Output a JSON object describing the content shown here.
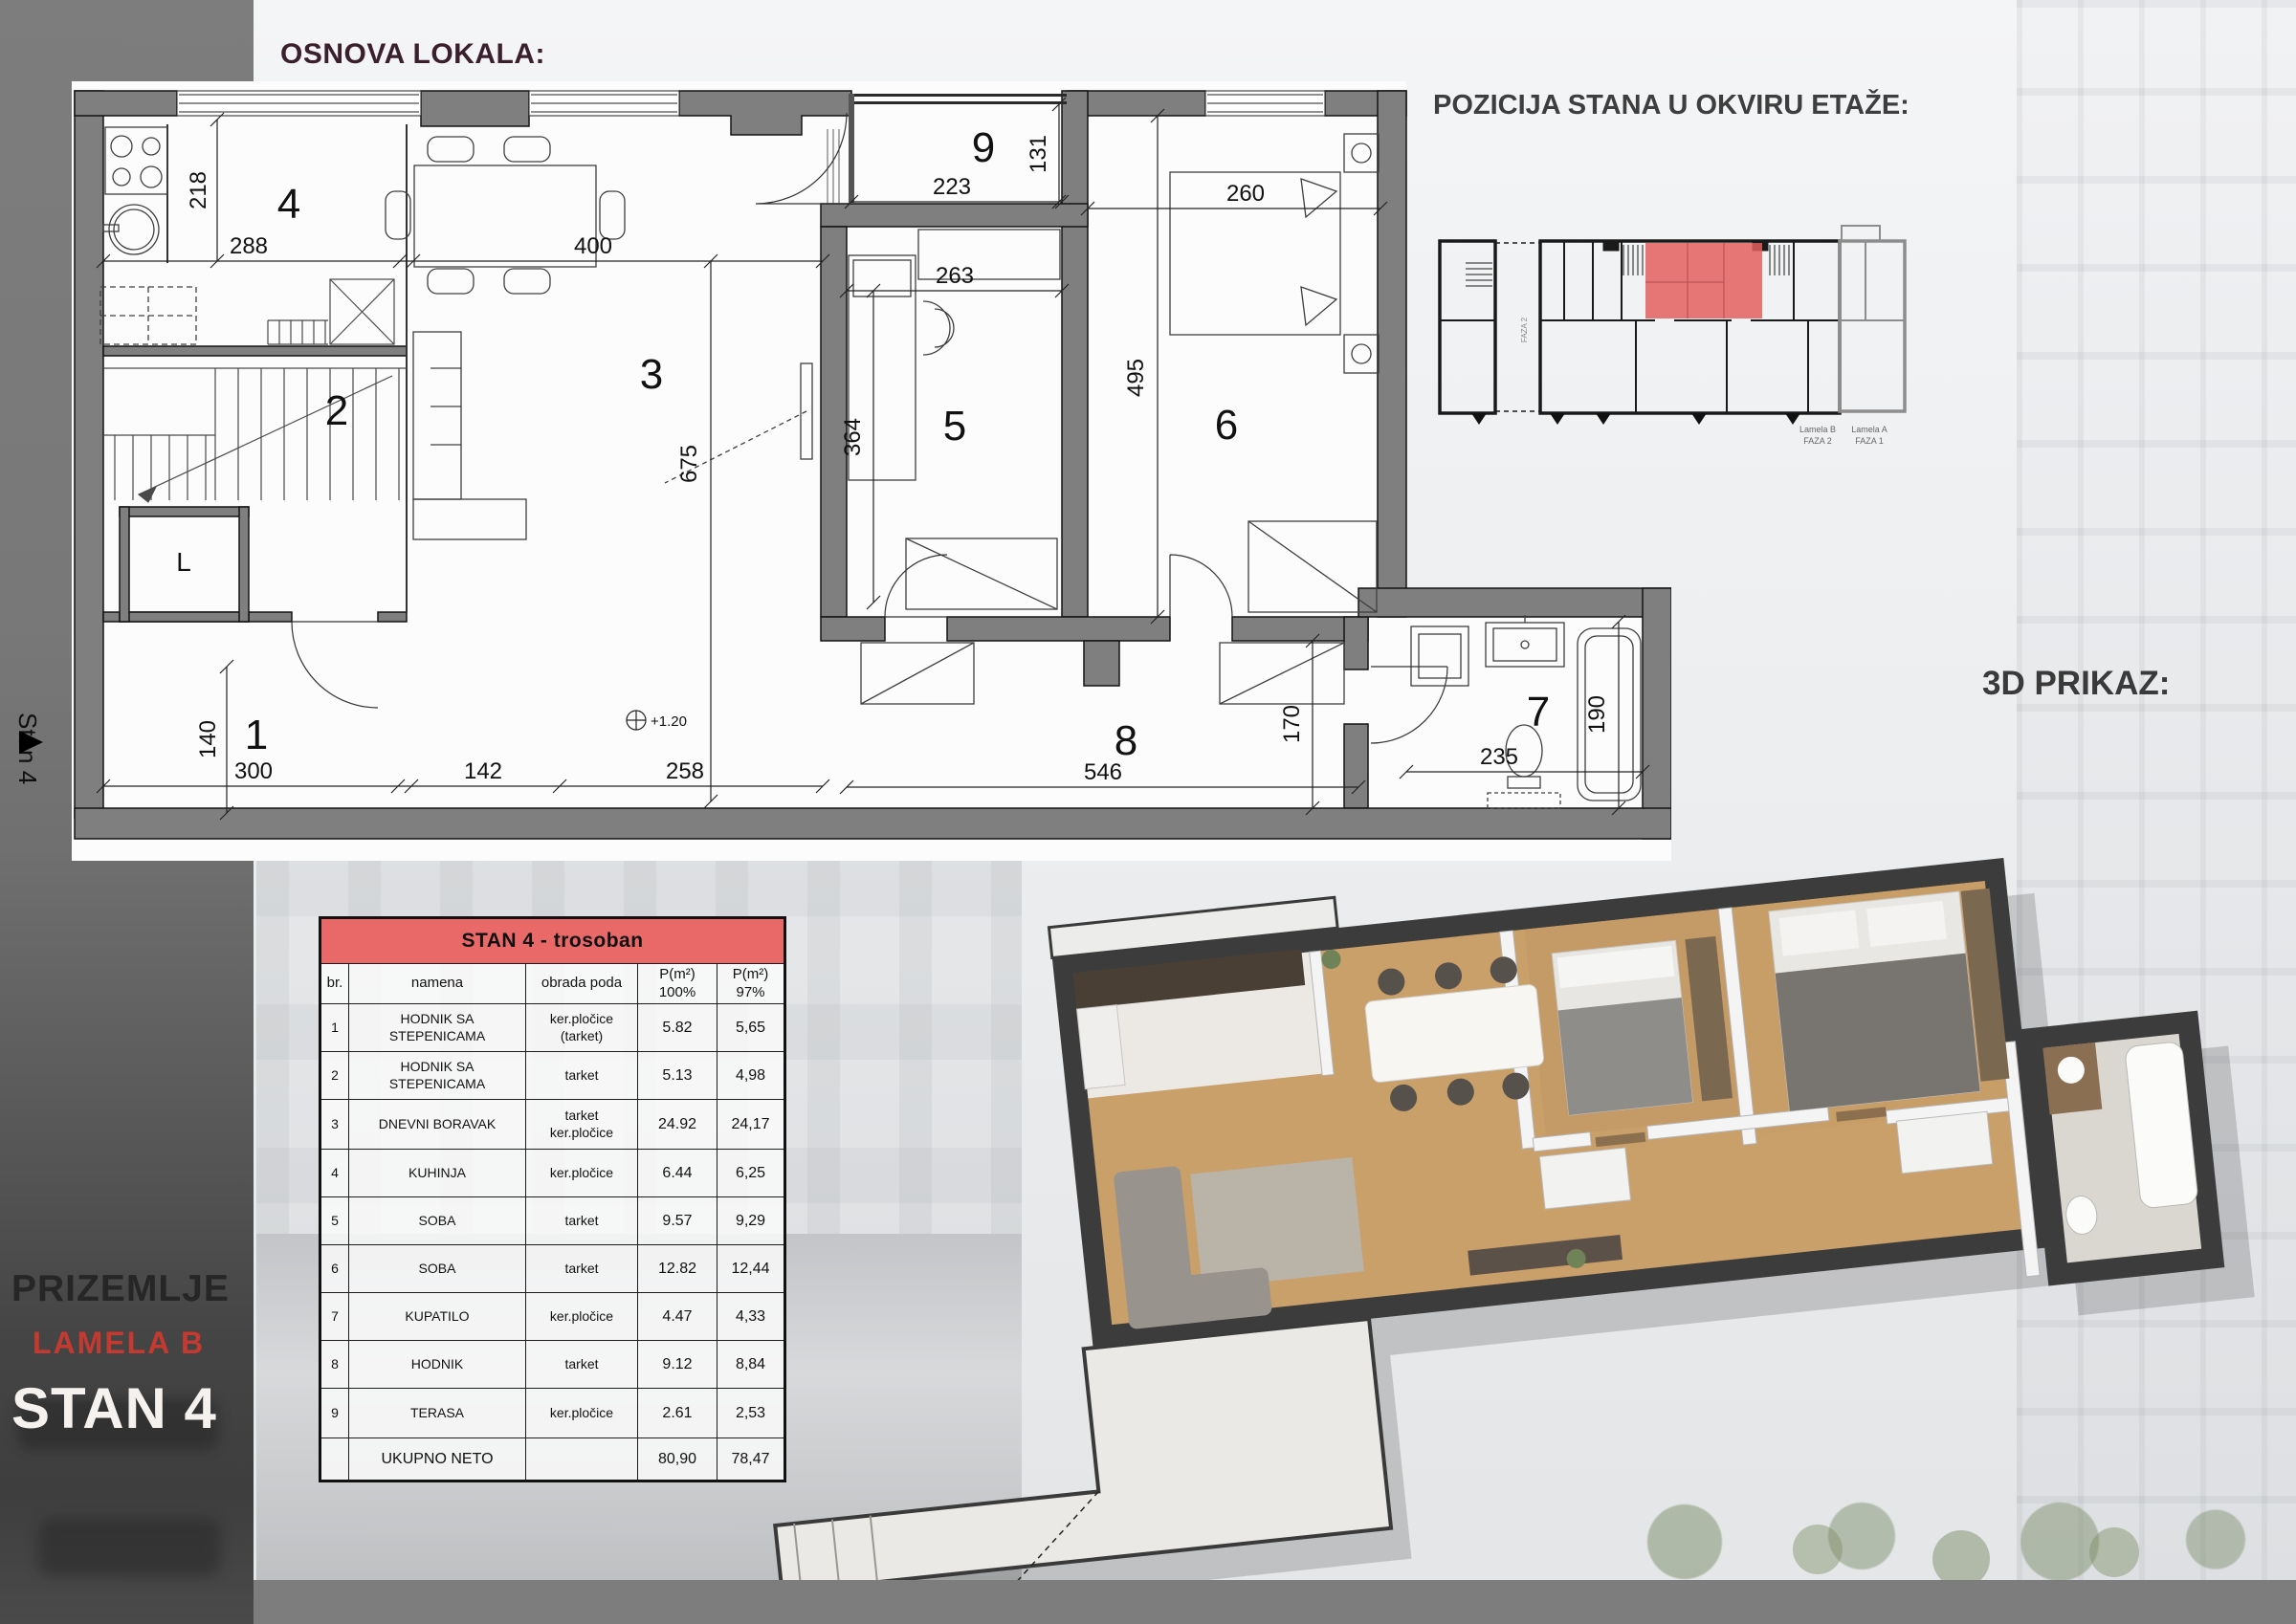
{
  "titles": {
    "osnova": "OSNOVA LOKALA:",
    "pozicija": "POZICIJA STANA U OKVIRU ETAŽE:",
    "prikaz3d": "3D PRIKAZ:"
  },
  "side_tab": {
    "label": "Stan 4"
  },
  "project": {
    "level": "PRIZEMLJE",
    "lamela": "LAMELA  B",
    "unit": "STAN 4"
  },
  "floorplan": {
    "rooms": {
      "r1": "1",
      "r2": "2",
      "r3": "3",
      "r4": "4",
      "r5": "5",
      "r6": "6",
      "r7": "7",
      "r8": "8",
      "r9": "9"
    },
    "elevator": "L",
    "level_mark": "+1.20",
    "dims": {
      "d140": "140",
      "d300": "300",
      "d142": "142",
      "d258": "258",
      "d218": "218",
      "d288": "288",
      "d400": "400",
      "d675": "675",
      "d223": "223",
      "d131": "131",
      "d263": "263",
      "d364": "364",
      "d260": "260",
      "d495": "495",
      "d546": "546",
      "d170": "170",
      "d235": "235",
      "d190": "190"
    }
  },
  "etage": {
    "faza_divider": "FAZA 2",
    "lamela_b_line1": "Lamela B",
    "lamela_b_line2": "FAZA 2",
    "lamela_a_line1": "Lamela A",
    "lamela_a_line2": "FAZA 1"
  },
  "table": {
    "title": "STAN  4 - trosoban",
    "headers": {
      "br": "br.",
      "namena": "namena",
      "obrada": "obrada poda",
      "p100": "P(m²)\n100%",
      "p97": "P(m²)\n97%"
    },
    "rows": [
      {
        "br": "1",
        "namena": "HODNIK SA\nSTEPENICAMA",
        "obrada": "ker.pločice\n(tarket)",
        "p100": "5.82",
        "p97": "5,65"
      },
      {
        "br": "2",
        "namena": "HODNIK SA\nSTEPENICAMA",
        "obrada": "tarket",
        "p100": "5.13",
        "p97": "4,98"
      },
      {
        "br": "3",
        "namena": "DNEVNI BORAVAK",
        "obrada": "tarket\nker.pločice",
        "p100": "24.92",
        "p97": "24,17"
      },
      {
        "br": "4",
        "namena": "KUHINJA",
        "obrada": "ker.pločice",
        "p100": "6.44",
        "p97": "6,25"
      },
      {
        "br": "5",
        "namena": "SOBA",
        "obrada": "tarket",
        "p100": "9.57",
        "p97": "9,29"
      },
      {
        "br": "6",
        "namena": "SOBA",
        "obrada": "tarket",
        "p100": "12.82",
        "p97": "12,44"
      },
      {
        "br": "7",
        "namena": "KUPATILO",
        "obrada": "ker.pločice",
        "p100": "4.47",
        "p97": "4,33"
      },
      {
        "br": "8",
        "namena": "HODNIK",
        "obrada": "tarket",
        "p100": "9.12",
        "p97": "8,84"
      },
      {
        "br": "9",
        "namena": "TERASA",
        "obrada": "ker.pločice",
        "p100": "2.61",
        "p97": "2,53"
      }
    ],
    "total": {
      "label": "UKUPNO NETO",
      "p100": "80,90",
      "p97": "78,47"
    }
  },
  "colors": {
    "accent_red": "#E96969",
    "highlight_red": "#E4605F",
    "lamela_red": "#C43A30",
    "wall_gray": "#7F7F7F",
    "band_gray": "#7D7D7D",
    "title_maroon": "#3A202C"
  }
}
